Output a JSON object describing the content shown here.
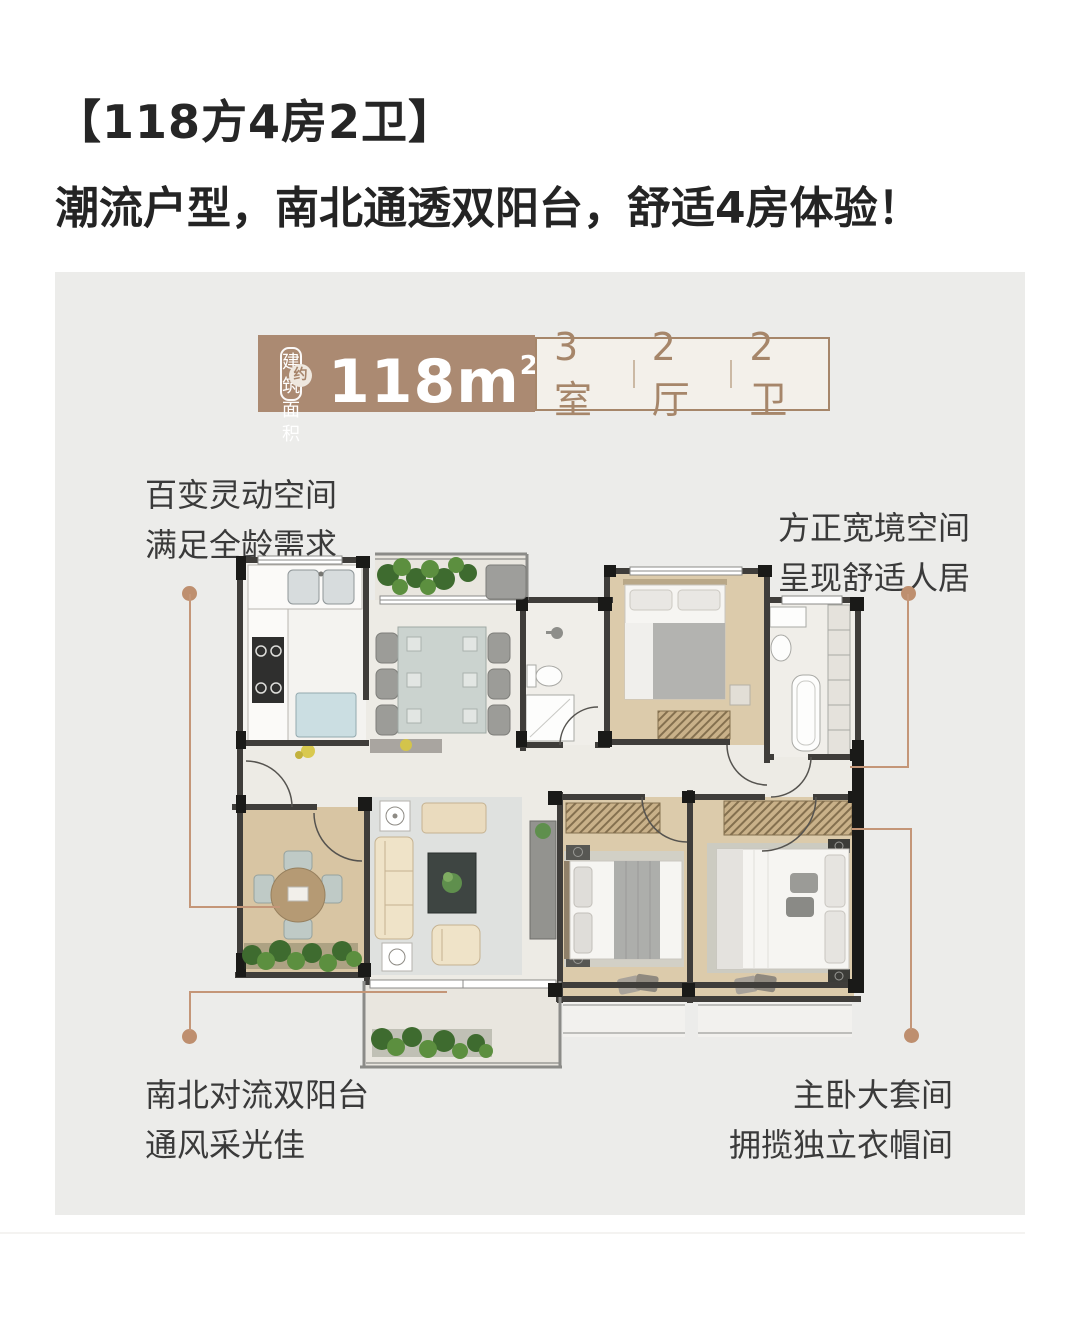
{
  "header": {
    "title": "【118方4房2卫】",
    "subtitle": "潮流户型，南北通透双阳台，舒适4房体验！"
  },
  "badge": {
    "area_label_line1": "建筑",
    "area_label_line2": "面积",
    "area_approx": "约",
    "area_value": "118m",
    "area_unit_sup": "2",
    "specs": [
      "3室",
      "2厅",
      "2卫"
    ]
  },
  "annotations": {
    "top_left": {
      "line1": "百变灵动空间",
      "line2": "满足全龄需求"
    },
    "top_right": {
      "line1": "方正宽境空间",
      "line2": "呈现舒适人居"
    },
    "bottom_left": {
      "line1": "南北对流双阳台",
      "line2": "通风采光佳"
    },
    "bottom_right": {
      "line1": "主卧大套间",
      "line2": "拥揽独立衣帽间"
    }
  },
  "colors": {
    "accent_brown": "#AB8A72",
    "spec_text_brown": "#A6866A",
    "connector_line": "#C49678",
    "connector_dot": "#BE8F6F",
    "panel_bg": "#ECECEA",
    "title_text": "#262626",
    "annotation_text": "#3A3A3A"
  }
}
